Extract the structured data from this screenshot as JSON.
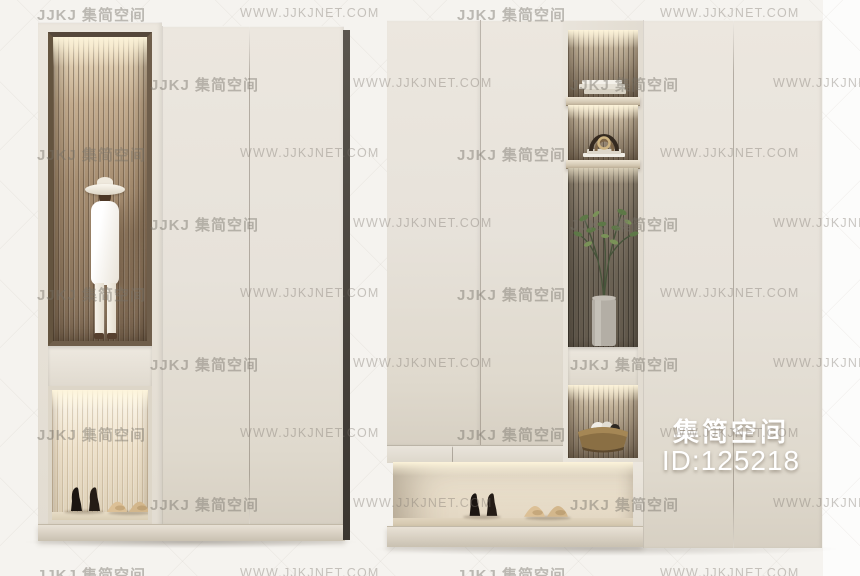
{
  "watermark": {
    "brand": "JJKJ 集简空间",
    "site": "WWW.JJKJNET.COM"
  },
  "overlay": {
    "brand_cn": "集简空间",
    "id_label": "ID:125218"
  },
  "palette": {
    "background": "#f5f3ef",
    "background_right_strip": "#fcfcfb",
    "cabinet_cream": "#e8e3da",
    "bronze_niche_frame": "#6f5e4b",
    "slat_warm": "#a98f72",
    "slat_gray": "#9c8f7b",
    "plinth": "#d6cec0",
    "side_edge_dark": "#3f3a33",
    "led_glow": "#fff4da",
    "watermark_gray": "#787068",
    "overlay_text": "#ffffff"
  },
  "scene": {
    "left_unit": {
      "label": "tall display wardrobe with slatted niche",
      "sections": [
        {
          "name": "upper-display-niche",
          "item": "mannequin-figurine-with-hat"
        },
        {
          "name": "middle-drawer-band",
          "item": ""
        },
        {
          "name": "lower-shoe-niche",
          "items": [
            "black-high-heels",
            "beige-flats"
          ]
        },
        {
          "name": "door-panel",
          "item": ""
        }
      ]
    },
    "right_unit": {
      "label": "wide wardrobe with lighted shelf column and shoe niche",
      "display_column_items": [
        "books-stack",
        "arch-sculpture-on-books",
        "plant-in-cylinder-vase",
        "closed-drawer-band",
        "decor-bowl-with-cloth"
      ],
      "shoe_niche_items": [
        "black-high-heels",
        "beige-flats"
      ]
    }
  }
}
